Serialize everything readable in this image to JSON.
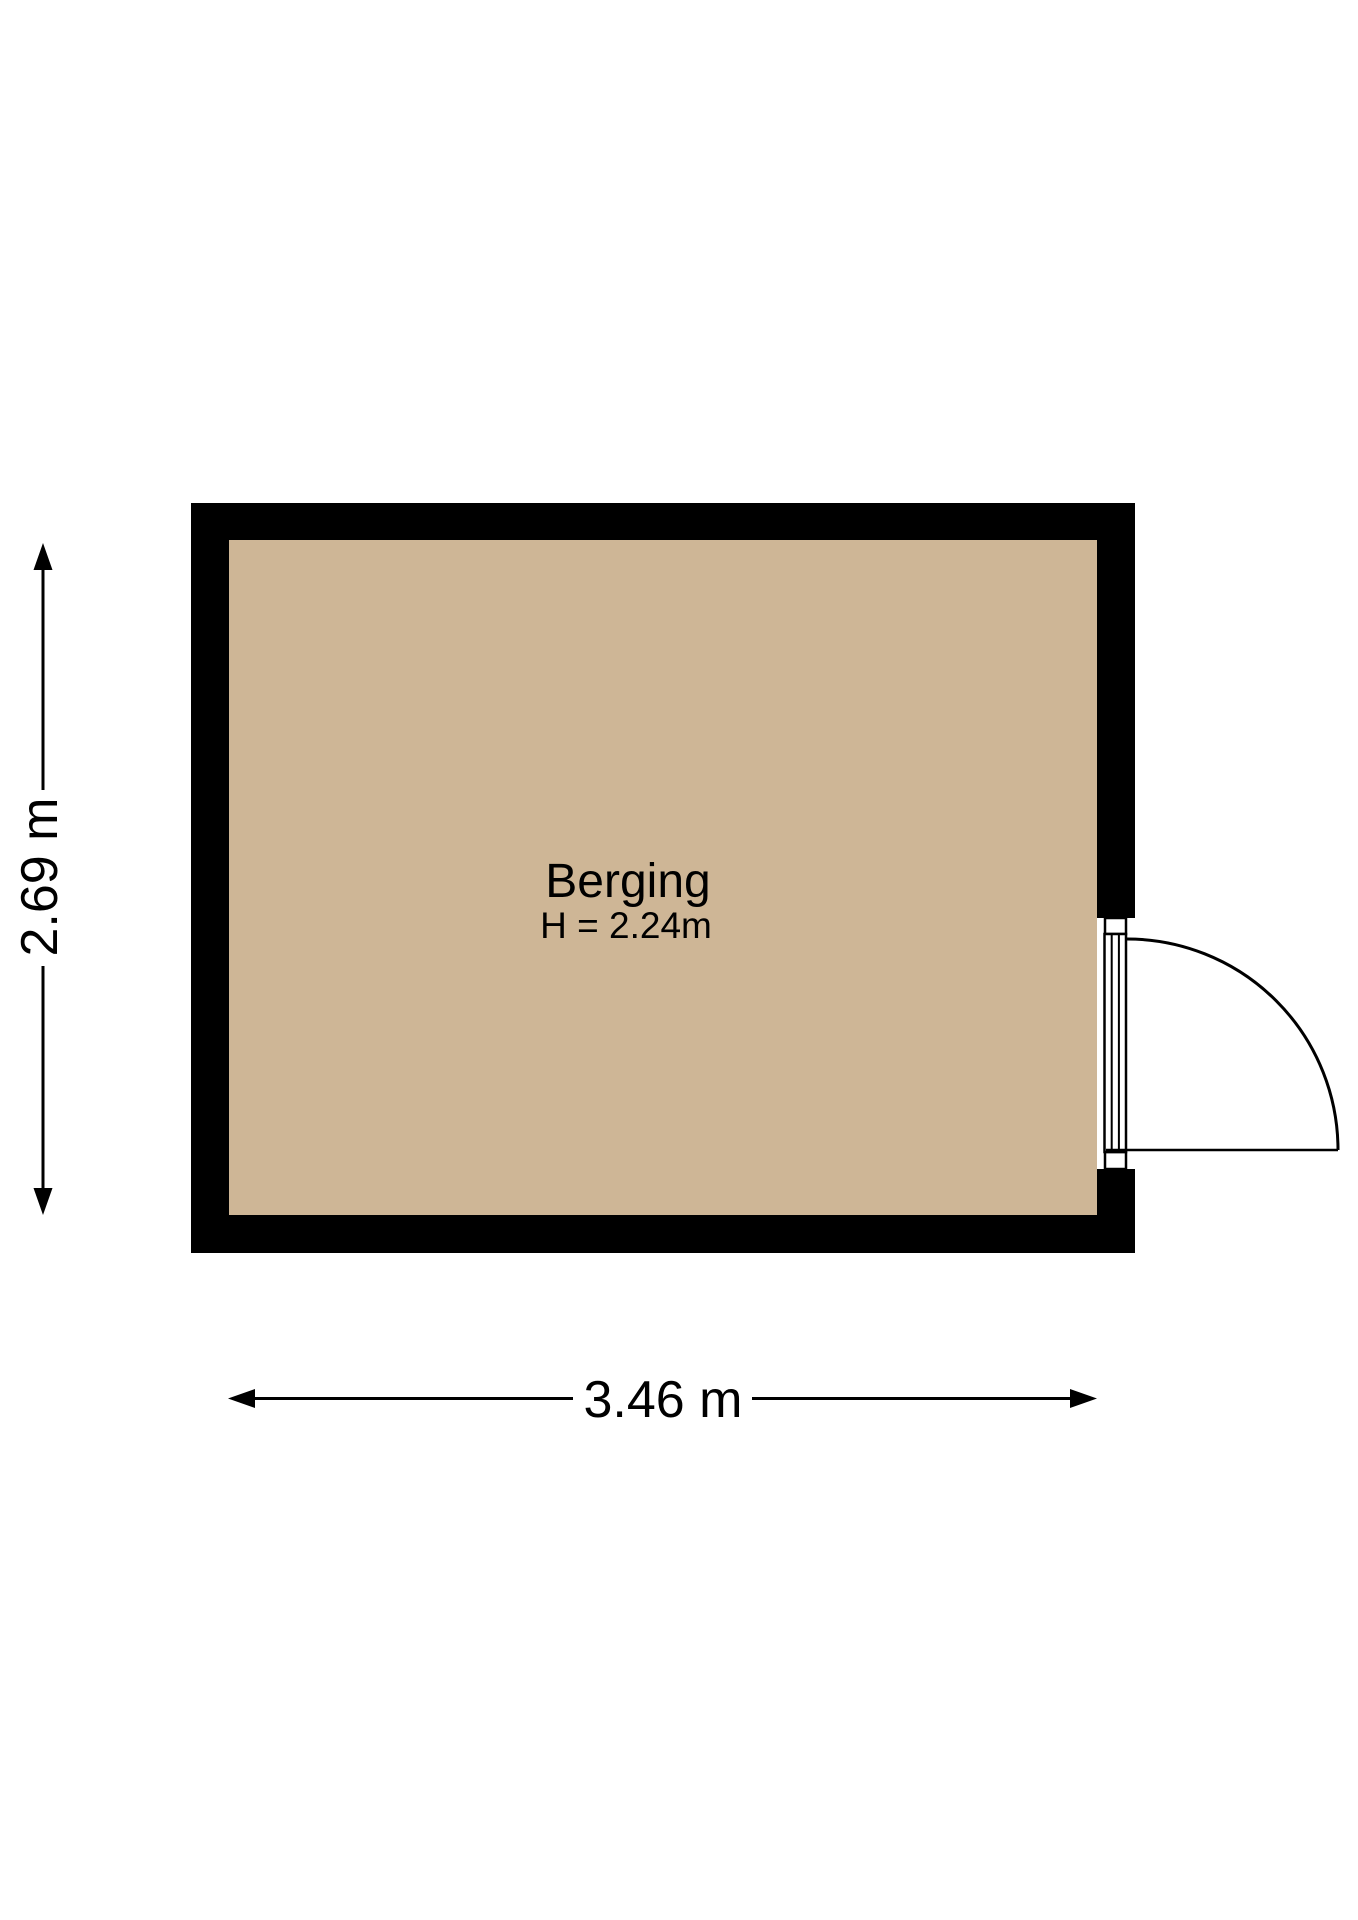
{
  "room": {
    "name": "Berging",
    "ceiling_height_label": "H = 2.24m"
  },
  "dimensions": {
    "vertical_label": "2.69 m",
    "horizontal_label": "3.46 m"
  },
  "colors": {
    "floor": "#ceb696",
    "wall": "#000000",
    "line": "#000000",
    "background": "#ffffff",
    "door_frame_fill": "#ffffff"
  }
}
